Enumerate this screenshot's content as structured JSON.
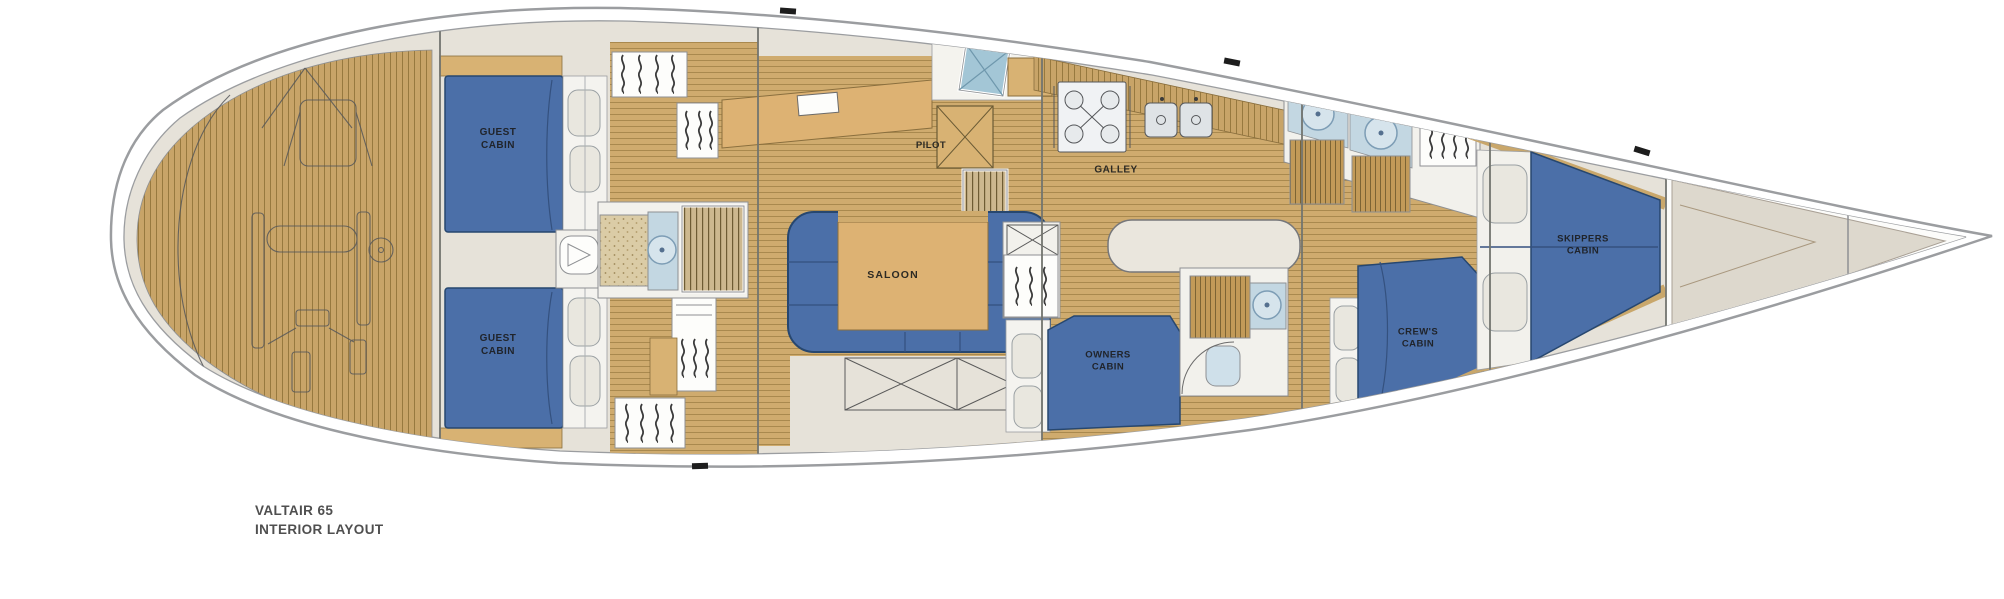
{
  "page": {
    "background": "#ffffff"
  },
  "title": {
    "line1": "VALTAIR 65",
    "line2": "INTERIOR LAYOUT"
  },
  "labels": {
    "guest_cabin_port": "GUEST CABIN",
    "guest_cabin_starboard": "GUEST CABIN",
    "saloon": "SALOON",
    "pilot": "PILOT",
    "galley": "GALLEY",
    "owners_cabin": "OWNERS CABIN",
    "crews_cabin": "CREW'S CABIN",
    "skippers_cabin": "SKIPPERS CABIN"
  },
  "colors": {
    "hull_outline": "#9b9da0",
    "deck_beige": "#e6e2d9",
    "teak": "#c9a76b",
    "teak_seam": "#96783f",
    "berth_blue": "#4b6fa8",
    "berth_outline": "#27476f",
    "furniture_tan": "#ddb273",
    "fixture_white": "#f2f1ec",
    "plumbing_blue": "#c3d7e2",
    "hatch_teal": "#a3c6d6",
    "label_text": "#20242b",
    "title_text": "#4f4f4f"
  }
}
